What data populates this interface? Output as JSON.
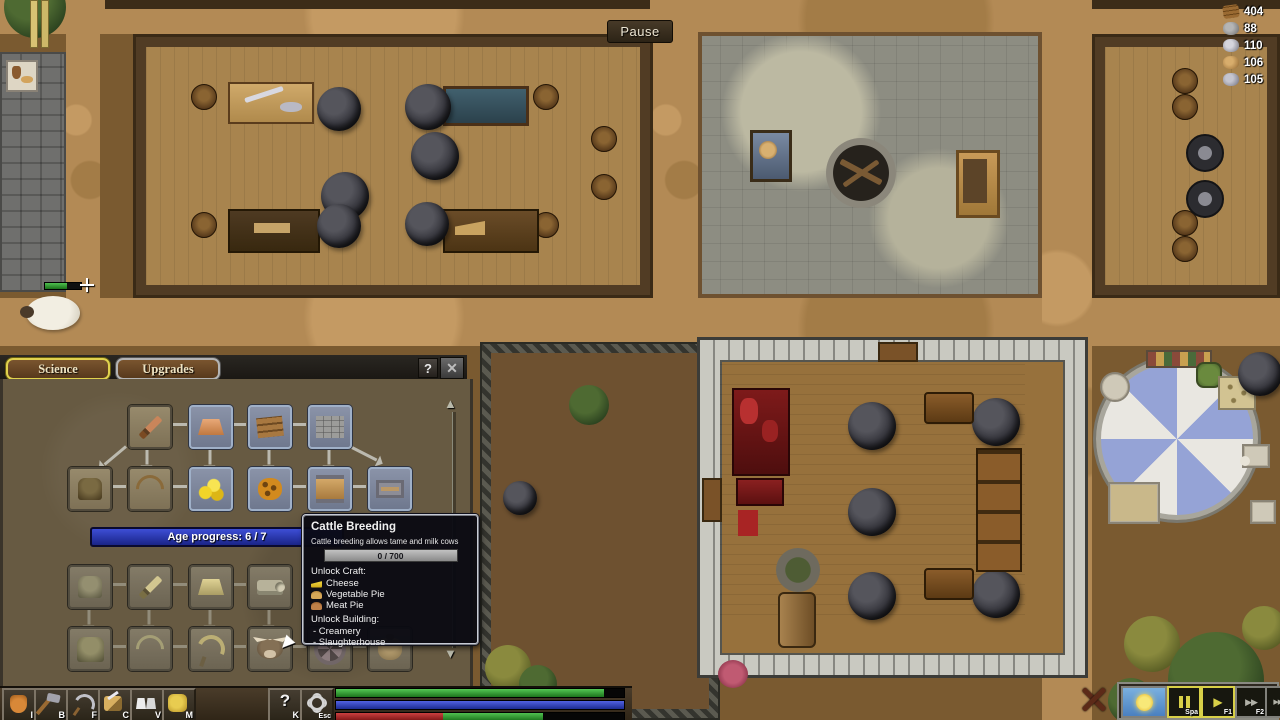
{
  "hud": {
    "pause_label": "Pause",
    "resources": [
      {
        "icon": "logs-icon",
        "value": "404"
      },
      {
        "icon": "stone-icon",
        "value": "88"
      },
      {
        "icon": "iron-ore-icon",
        "value": "110"
      },
      {
        "icon": "clay-icon",
        "value": "106"
      },
      {
        "icon": "silver-ore-icon",
        "value": "105"
      }
    ]
  },
  "science_panel": {
    "tabs": [
      {
        "label": "Science",
        "active": true
      },
      {
        "label": "Upgrades",
        "active": false
      }
    ],
    "help_label": "?",
    "close_label": "✕",
    "age_progress": "Age progress: 6 / 7",
    "scroll_up": "▲",
    "scroll_down": "▼",
    "tree_nodes": [
      {
        "icon": "wooden-sword-icon",
        "state": "researched"
      },
      {
        "icon": "copper-ingot-icon",
        "state": "available"
      },
      {
        "icon": "planks-icon",
        "state": "available"
      },
      {
        "icon": "stone-wall-icon",
        "state": "available"
      },
      {
        "icon": "leather-armor-icon",
        "state": "researched"
      },
      {
        "icon": "bow-icon",
        "state": "researched"
      },
      {
        "icon": "coins-icon",
        "state": "available"
      },
      {
        "icon": "honeycomb-icon",
        "state": "available"
      },
      {
        "icon": "tanned-leather-icon",
        "state": "available"
      },
      {
        "icon": "loom-icon",
        "state": "available"
      },
      {
        "icon": "chain-armor-icon",
        "state": "locked"
      },
      {
        "icon": "steel-sword-icon",
        "state": "locked"
      },
      {
        "icon": "gold-ingot-icon",
        "state": "locked"
      },
      {
        "icon": "fabric-icon",
        "state": "locked"
      },
      {
        "icon": "plate-armor-icon",
        "state": "locked"
      },
      {
        "icon": "longbow-icon",
        "state": "locked"
      },
      {
        "icon": "sickle-icon",
        "state": "locked"
      },
      {
        "icon": "cattle-breeding-icon",
        "state": "locked-hovered"
      },
      {
        "icon": "cart-wheel-icon",
        "state": "locked"
      },
      {
        "icon": "grain-sack-icon",
        "state": "locked"
      }
    ],
    "toolbar": [
      {
        "icon": "inventory-bag-icon",
        "hotkey": "I"
      },
      {
        "icon": "build-hammer-icon",
        "hotkey": "B"
      },
      {
        "icon": "farm-sickle-icon",
        "hotkey": "F"
      },
      {
        "icon": "craft-tools-icon",
        "hotkey": "C"
      },
      {
        "icon": "villagers-icon",
        "hotkey": "V"
      },
      {
        "icon": "map-icon",
        "hotkey": "M"
      }
    ],
    "help_button": {
      "label": "?",
      "hotkey": "K"
    },
    "settings_button": {
      "icon": "gear-icon",
      "hotkey": "Esc"
    },
    "status_bars": {
      "top": 93,
      "middle": 100,
      "bottom_red": 37,
      "bottom_green": 35
    }
  },
  "tooltip": {
    "title": "Cattle Breeding",
    "description": "Cattle breeding allows tame and milk cows",
    "progress": "0 / 700",
    "unlock_craft_label": "Unlock Craft:",
    "craft_items": [
      {
        "icon": "cheese-icon",
        "label": "Cheese"
      },
      {
        "icon": "vegetable-pie-icon",
        "label": "Vegetable Pie"
      },
      {
        "icon": "meat-pie-icon",
        "label": "Meat Pie"
      }
    ],
    "unlock_building_label": "Unlock Building:",
    "buildings": [
      "- Creamery",
      "- Slaughterhouse"
    ]
  },
  "speed_controls": {
    "buttons": [
      {
        "icon": "sun-icon",
        "hotkey": ""
      },
      {
        "icon": "pause-bars-icon",
        "hotkey": "Spa"
      },
      {
        "icon": "play-icon",
        "label": "▶",
        "hotkey": "F1"
      },
      {
        "icon": "fast-forward-icon",
        "label": "▶▶",
        "hotkey": "F2"
      },
      {
        "icon": "fastest-forward-icon",
        "label": "▶▶▶",
        "hotkey": "F3"
      }
    ]
  },
  "colors": {
    "accent_gold": "#e0d24e",
    "accent_blue": "#2a3acc",
    "panel_bg": "#675a42",
    "tooltip_bg": "#0a0a12"
  }
}
